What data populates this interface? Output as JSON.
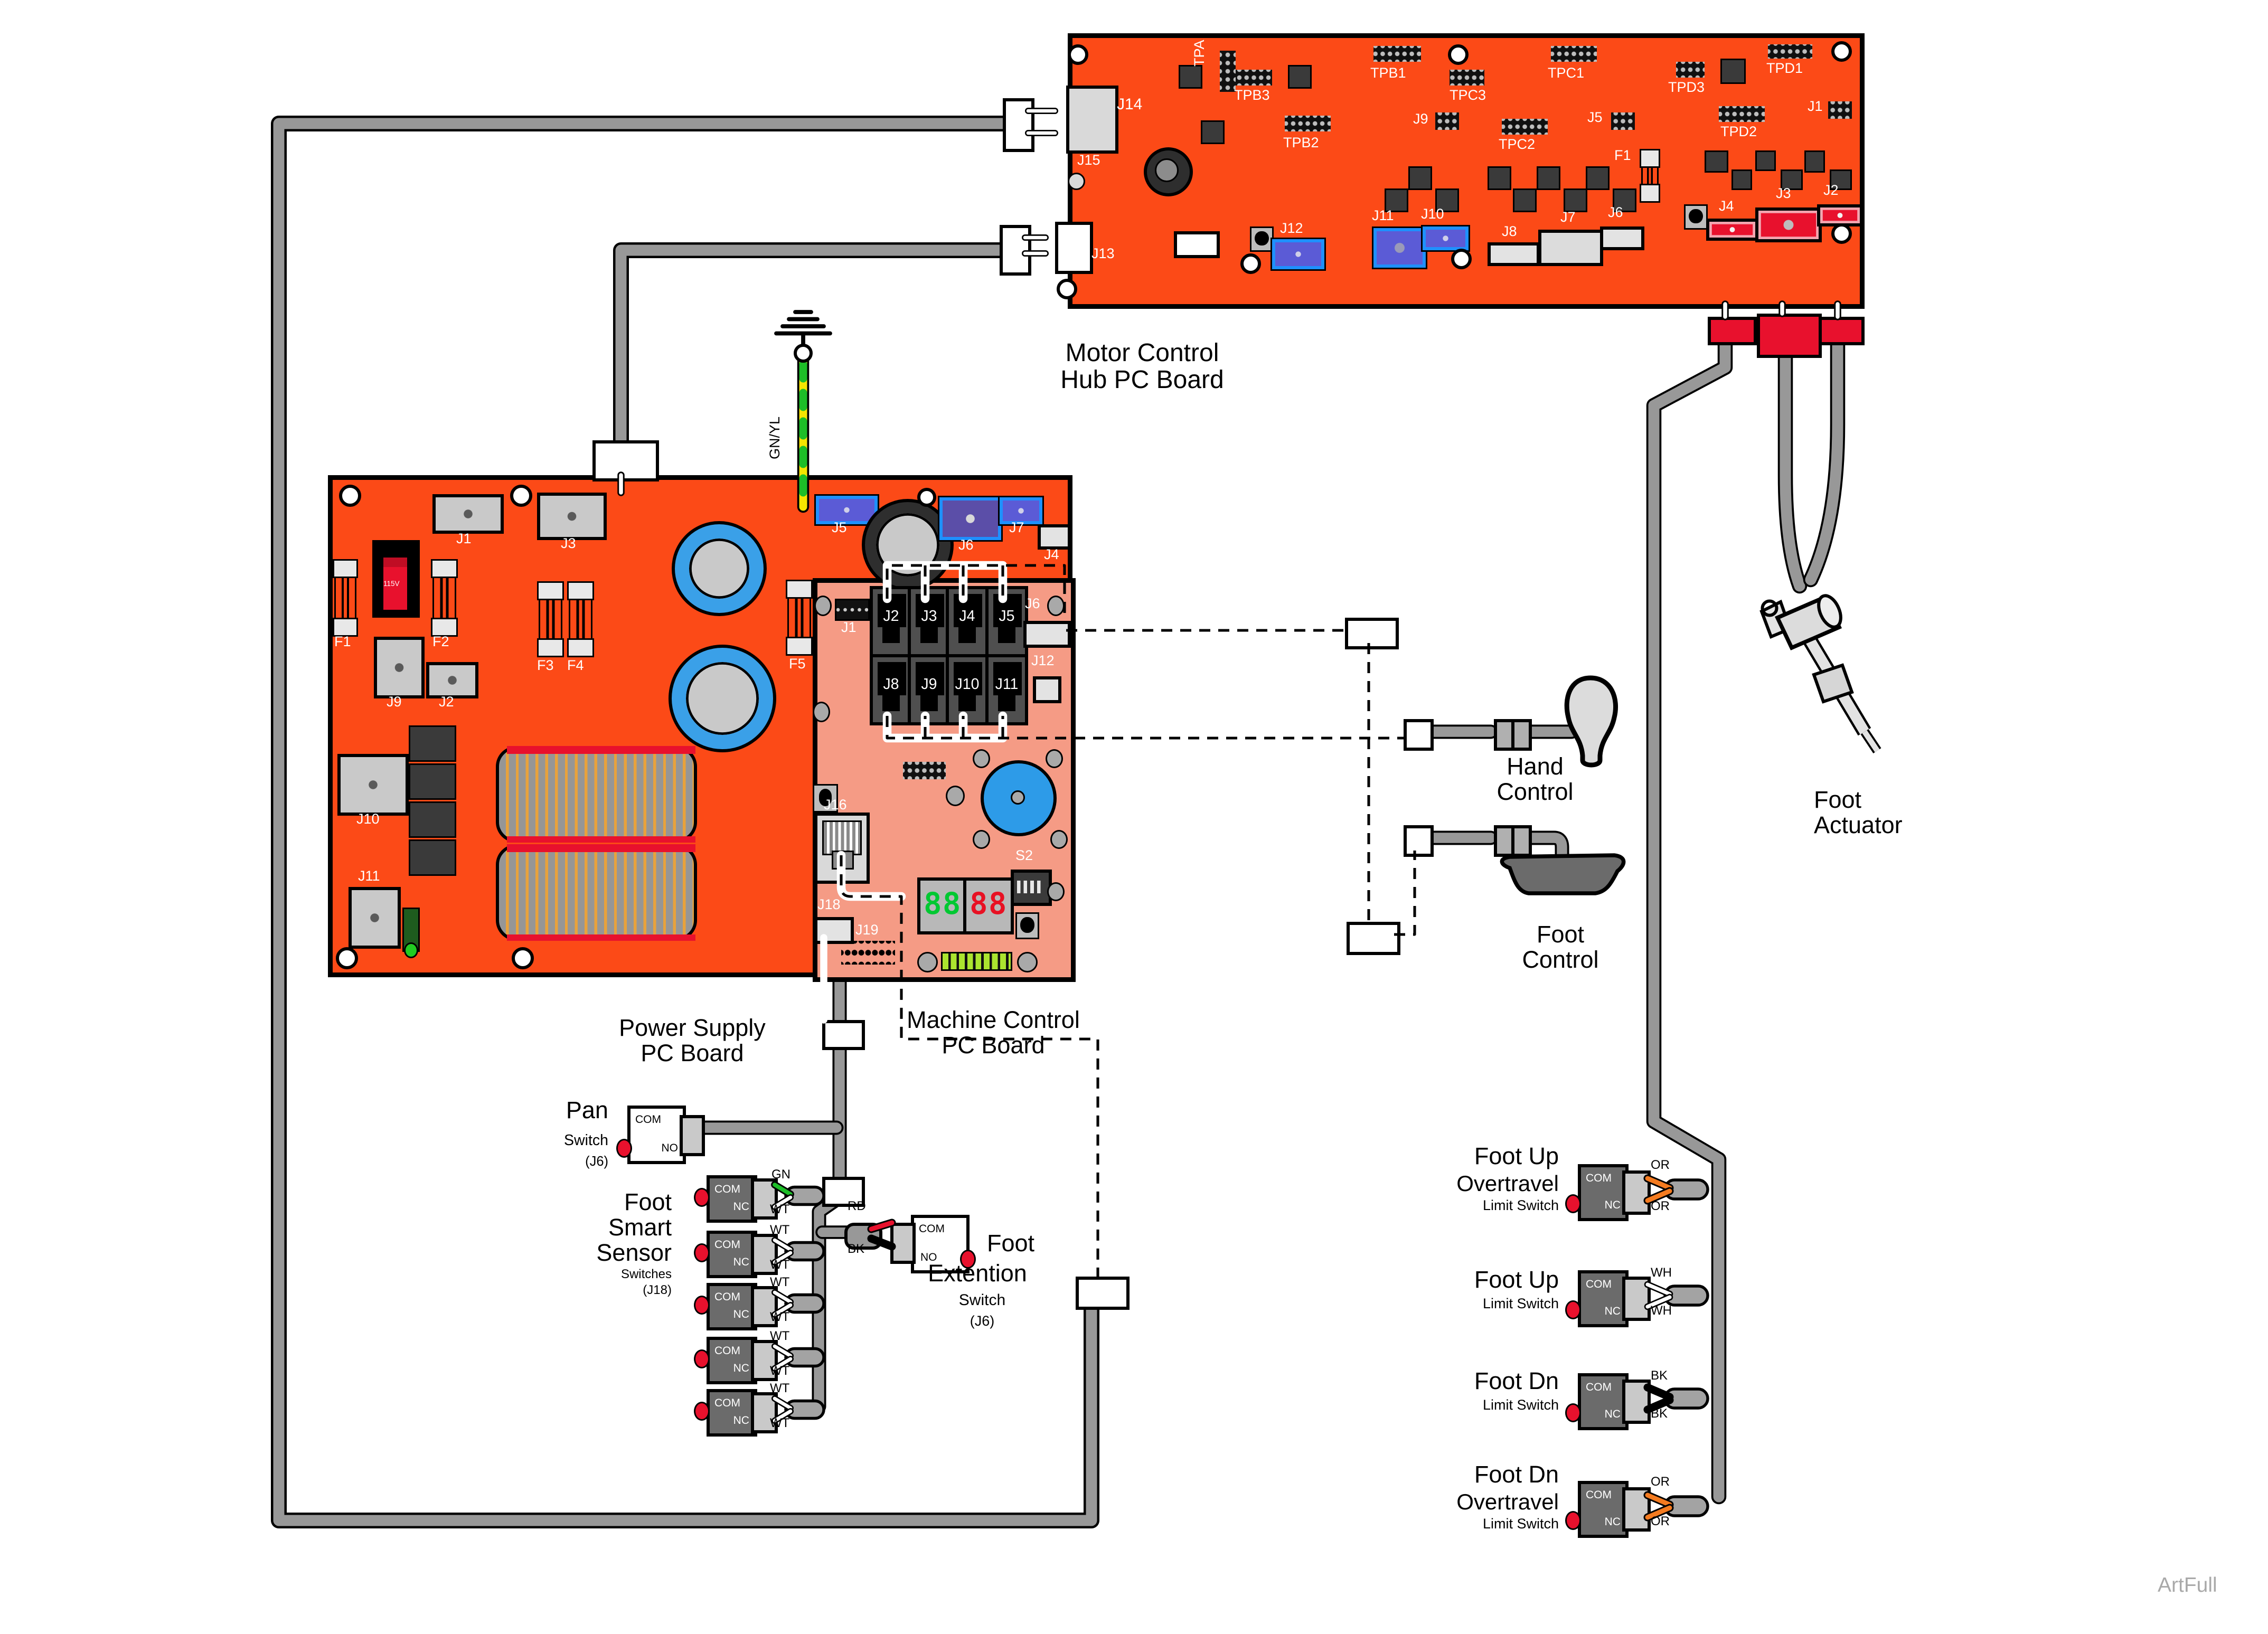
{
  "watermark": "ArtFull",
  "titles": {
    "motor1": "Motor Control",
    "motor2": "Hub PC Board",
    "power1": "Power Supply",
    "power2": "PC Board",
    "machine1": "Machine Control",
    "machine2": "PC Board"
  },
  "motor_refs": {
    "j14": "J14",
    "j15": "J15",
    "j13": "J13",
    "tpa": "TPA",
    "tpb3": "TPB3",
    "tpb2": "TPB2",
    "tpb1": "TPB1",
    "tpc3": "TPC3",
    "tpc1": "TPC1",
    "tpc2": "TPC2",
    "tpd3": "TPD3",
    "tpd1": "TPD1",
    "tpd2": "TPD2",
    "j9": "J9",
    "j5": "J5",
    "j1": "J1",
    "f1": "F1",
    "j12": "J12",
    "j11": "J11",
    "j10": "J10",
    "j8": "J8",
    "j7": "J7",
    "j6": "J6",
    "j4": "J4",
    "j3": "J3",
    "j2": "J2"
  },
  "power_refs": {
    "j1": "J1",
    "j3": "J3",
    "volt": "115V",
    "f1": "F1",
    "f2": "F2",
    "j9": "J9",
    "j2": "J2",
    "f3": "F3",
    "f4": "F4",
    "f5": "F5",
    "j10": "J10",
    "j11": "J11",
    "j5": "J5",
    "j6": "J6",
    "j7": "J7",
    "j4": "J4"
  },
  "machine_refs": {
    "j1": "J1",
    "j2": "J2",
    "j3": "J3",
    "j4": "J4",
    "j5": "J5",
    "j6": "J6",
    "j8": "J8",
    "j9": "J9",
    "j10": "J10",
    "j11": "J11",
    "j12": "J12",
    "j16": "J16",
    "j18": "J18",
    "j19": "J19",
    "s2": "S2"
  },
  "display": {
    "green": "88",
    "red": "88"
  },
  "ground_wire_label": "GN/YL",
  "pan": {
    "title": "Pan",
    "sub": "Switch",
    "ref": "(J6)",
    "c1": "COM",
    "c2": "NO"
  },
  "smart": {
    "l1": "Foot",
    "l2": "Smart",
    "l3": "Sensor",
    "sub": "Switches",
    "ref": "(J18)",
    "c1": "COM",
    "c2": "NC",
    "w_green": "GN",
    "w_white": "WT"
  },
  "ext": {
    "t1": "Foot",
    "t2": "Extention",
    "sub": "Switch",
    "ref": "(J6)",
    "c1": "COM",
    "c2": "NO",
    "w1": "RD",
    "w2": "BK"
  },
  "hand": {
    "l1": "Hand",
    "l2": "Control"
  },
  "footctl": {
    "l1": "Foot",
    "l2": "Control"
  },
  "actuator": {
    "l1": "Foot",
    "l2": "Actuator"
  },
  "limits": [
    {
      "l1": "Foot Up",
      "l2": "Overtravel",
      "l3": "Limit Switch",
      "c1": "COM",
      "c2": "NC",
      "wt": "OR",
      "wb": "OR"
    },
    {
      "l1": "Foot Up",
      "l2": "",
      "l3": "Limit Switch",
      "c1": "COM",
      "c2": "NC",
      "wt": "WH",
      "wb": "WH"
    },
    {
      "l1": "Foot Dn",
      "l2": "",
      "l3": "Limit Switch",
      "c1": "COM",
      "c2": "NC",
      "wt": "BK",
      "wb": "BK"
    },
    {
      "l1": "Foot Dn",
      "l2": "Overtravel",
      "l3": "Limit Switch",
      "c1": "COM",
      "c2": "NC",
      "wt": "OR",
      "wb": "OR"
    }
  ]
}
